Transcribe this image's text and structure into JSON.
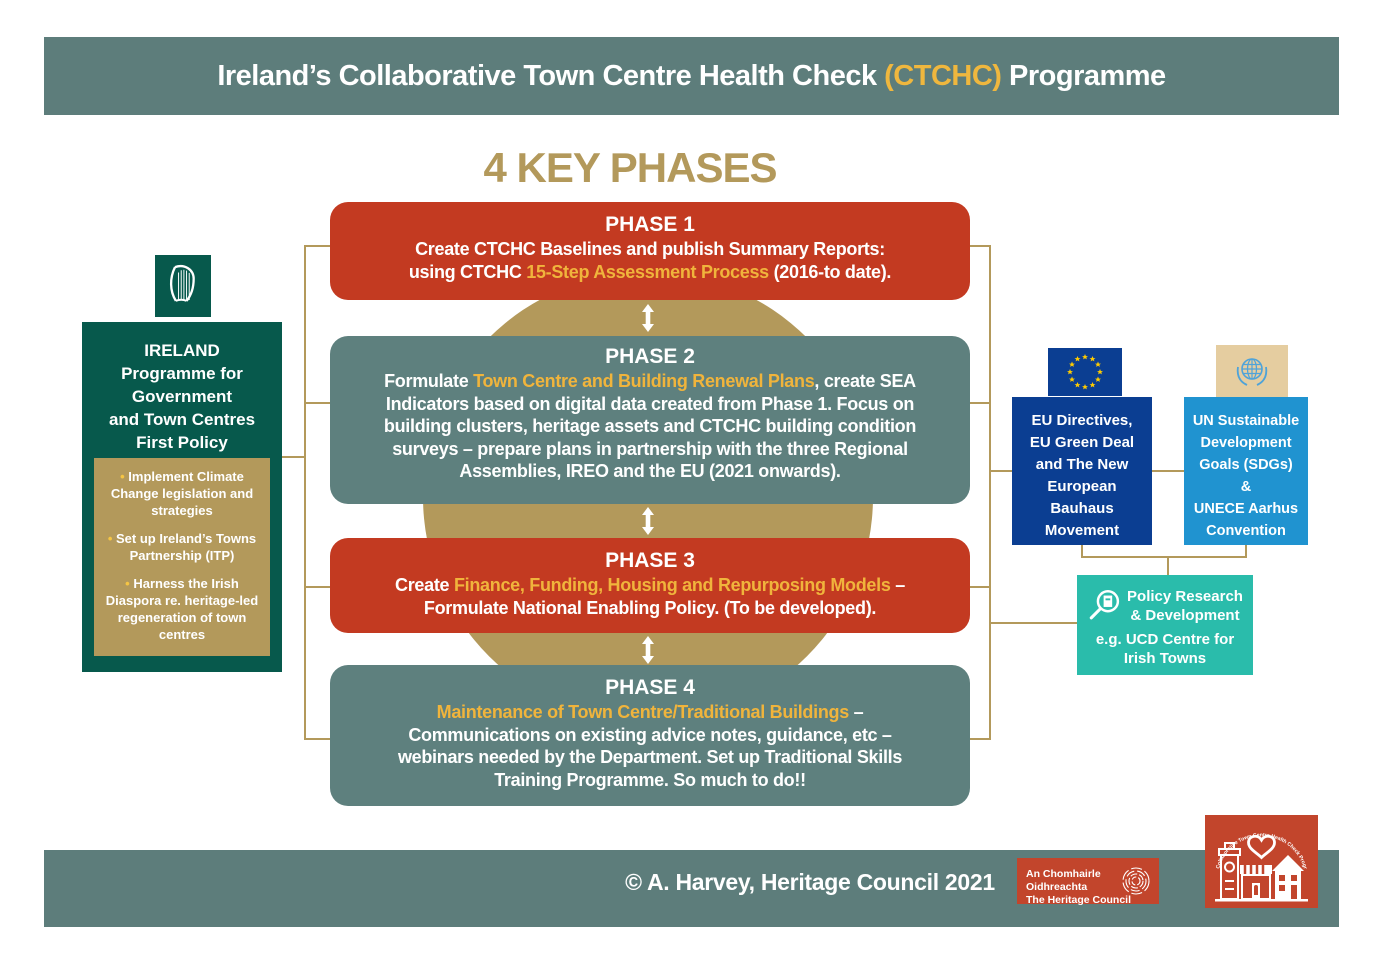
{
  "colors": {
    "bar_slate": "#5d7d7b",
    "phase_red": "#c33a21",
    "phase_slate": "#5e807e",
    "gold": "#b3995b",
    "gold_text": "#f0b43c",
    "dark_green": "#07594c",
    "eu_blue": "#0b3e92",
    "un_blue": "#2093d0",
    "policy_teal": "#2abcab",
    "logo_red": "#c2452c"
  },
  "header": {
    "title_prefix": "Ireland’s Collaborative Town Centre Health Check ",
    "title_highlight": "(CTCHC)",
    "title_suffix": " Programme"
  },
  "section_title": "4 KEY PHASES",
  "phases": [
    {
      "title": "PHASE 1",
      "segments": [
        {
          "text": "Create CTCHC Baselines and publish Summary Reports:\nusing CTCHC ",
          "highlight": false
        },
        {
          "text": "15-Step Assessment Process",
          "highlight": true
        },
        {
          "text": " (2016-to date).",
          "highlight": false
        }
      ]
    },
    {
      "title": "PHASE 2",
      "segments": [
        {
          "text": "Formulate ",
          "highlight": false
        },
        {
          "text": "Town Centre and Building Renewal Plans",
          "highlight": true
        },
        {
          "text": ", create SEA\nIndicators based on digital data created from Phase 1. Focus on\nbuilding clusters, heritage assets and CTCHC building condition\nsurveys – prepare plans in partnership with the three Regional\nAssemblies, IREO and the EU (2021 onwards).",
          "highlight": false
        }
      ]
    },
    {
      "title": "PHASE 3",
      "segments": [
        {
          "text": "Create ",
          "highlight": false
        },
        {
          "text": "Finance, Funding, Housing and Repurposing Models",
          "highlight": true
        },
        {
          "text": " –\nFormulate National Enabling Policy. (To be developed).",
          "highlight": false
        }
      ]
    },
    {
      "title": "PHASE 4",
      "segments": [
        {
          "text": "Maintenance of Town Centre/Traditional Buildings",
          "highlight": true
        },
        {
          "text": " –\nCommunications on existing advice notes, guidance, etc –\nwebinars needed by the Department. Set up Traditional Skills\nTraining Programme. So much to do!!",
          "highlight": false
        }
      ]
    }
  ],
  "ireland_panel": {
    "title": "IRELAND\nProgramme for\nGovernment\nand Town Centres\nFirst Policy",
    "bullets": [
      "Implement Climate Change legislation and strategies",
      "Set up Ireland’s Towns Partnership (ITP)",
      "Harness the Irish Diaspora re. heritage-led regeneration of town centres"
    ]
  },
  "eu_panel": {
    "label": "EU Directives,\nEU Green Deal\nand The New\nEuropean\nBauhaus\nMovement"
  },
  "un_panel": {
    "label": "UN Sustainable\nDevelopment\nGoals (SDGs)\n&\nUNECE Aarhus\nConvention"
  },
  "policy_panel": {
    "title": "Policy Research\n& Development",
    "subtitle": "e.g. UCD Centre for\nIrish Towns"
  },
  "footer": {
    "copyright": "© A. Harvey, Heritage Council 2021",
    "heritage_logo_line1": "An Chomhairle Oidhreachta",
    "heritage_logo_line2": "The Heritage Council",
    "ctchc_logo_arc": "Collaborative Town Centre Health Check Programme"
  }
}
